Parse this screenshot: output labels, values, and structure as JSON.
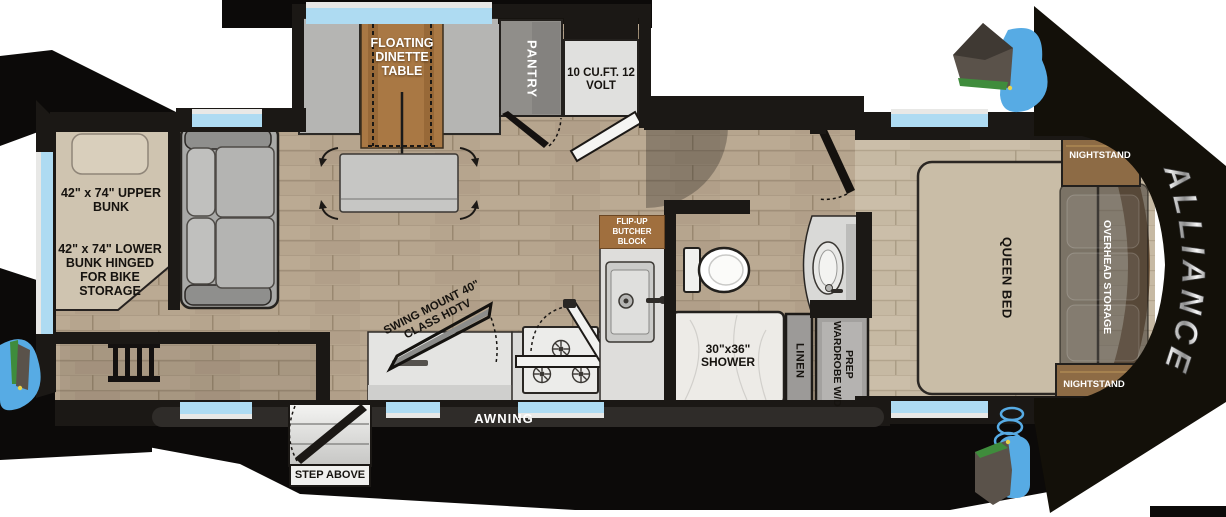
{
  "floorplan": {
    "brand_logo": "ALLIANCE",
    "slide": {
      "dinette_label": "FLOATING DINETTE TABLE",
      "pantry_label": "PANTRY",
      "fridge_label": "10 CU.FT. 12 VOLT"
    },
    "bunk_room": {
      "upper_bunk_label": "42\" x 74\" UPPER BUNK",
      "lower_bunk_label": "42\" x 74\" LOWER BUNK HINGED FOR BIKE STORAGE"
    },
    "living": {
      "tv_label": "SWING MOUNT 40\" CLASS HDTV"
    },
    "kitchen": {
      "butcher_block_label": "FLIP-UP BUTCHER BLOCK"
    },
    "bathroom": {
      "shower_label": "30\"x36\" SHOWER",
      "linen_label": "LINEN",
      "wardrobe_label": "WARDROBE W/D PREP"
    },
    "bedroom": {
      "bed_label": "QUEEN BED",
      "overhead_label": "OVERHEAD STORAGE",
      "nightstand_label": "NIGHTSTAND"
    },
    "exterior": {
      "awning_label": "AWNING",
      "step_label": "STEP ABOVE"
    },
    "colors": {
      "accent_blue": "#57abe4",
      "wood_floor": "#b6a58e",
      "wall_black": "#16130f",
      "window_blue": "#aedbf2"
    }
  }
}
